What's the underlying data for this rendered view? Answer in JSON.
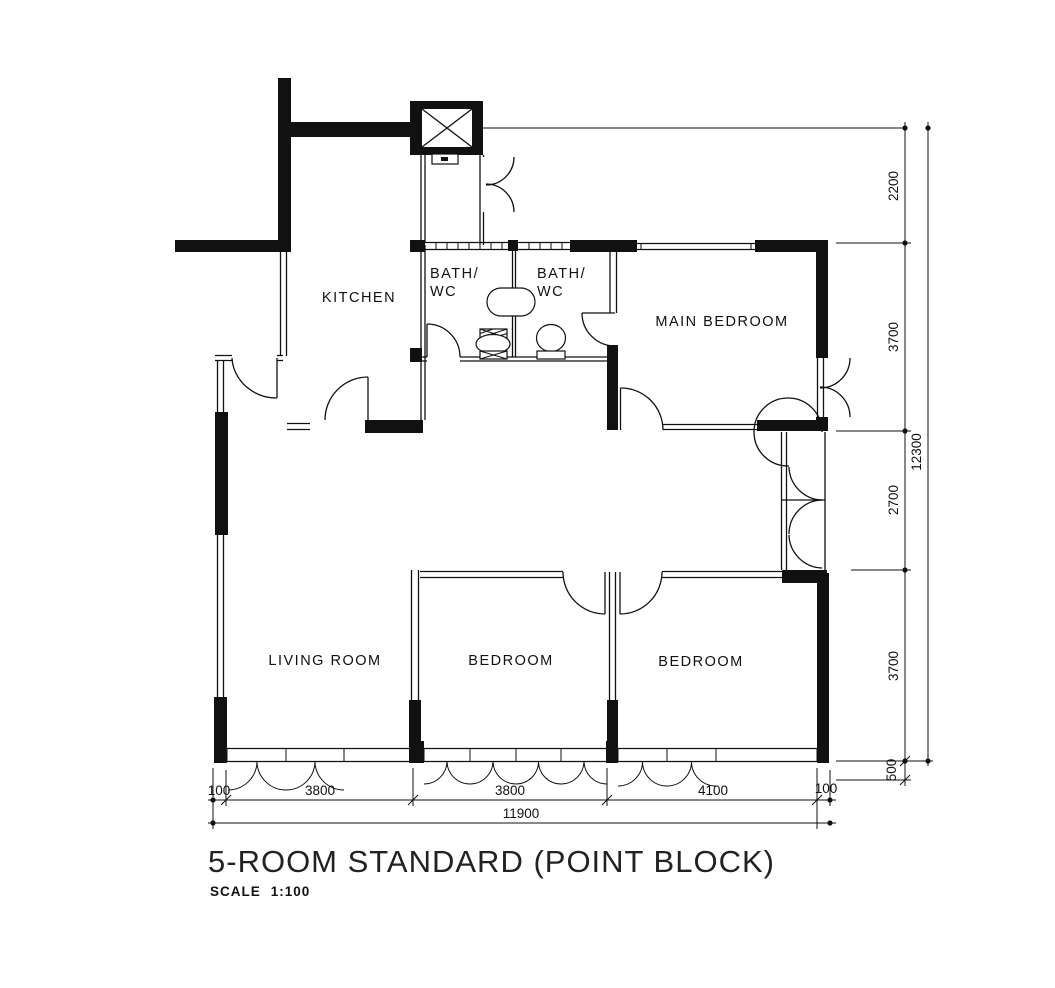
{
  "drawing": {
    "title": "5-ROOM STANDARD (POINT BLOCK)",
    "scale_label": "SCALE",
    "scale_value": "1:100"
  },
  "rooms": {
    "kitchen": "KITCHEN",
    "bath1_line1": "BATH/",
    "bath1_line2": "WC",
    "bath2_line1": "BATH/",
    "bath2_line2": "WC",
    "main_bedroom": "MAIN BEDROOM",
    "living_room": "LIVING ROOM",
    "bedroom1": "BEDROOM",
    "bedroom2": "BEDROOM"
  },
  "dimensions": {
    "bottom": {
      "d100_left": "100",
      "d3800_left": "3800",
      "d3800_mid": "3800",
      "d4100": "4100",
      "d100_right": "100",
      "total": "11900"
    },
    "right": {
      "d2200": "2200",
      "d3700_top": "3700",
      "d2700": "2700",
      "d3700_bottom": "3700",
      "d500": "500",
      "total": "12300"
    }
  }
}
